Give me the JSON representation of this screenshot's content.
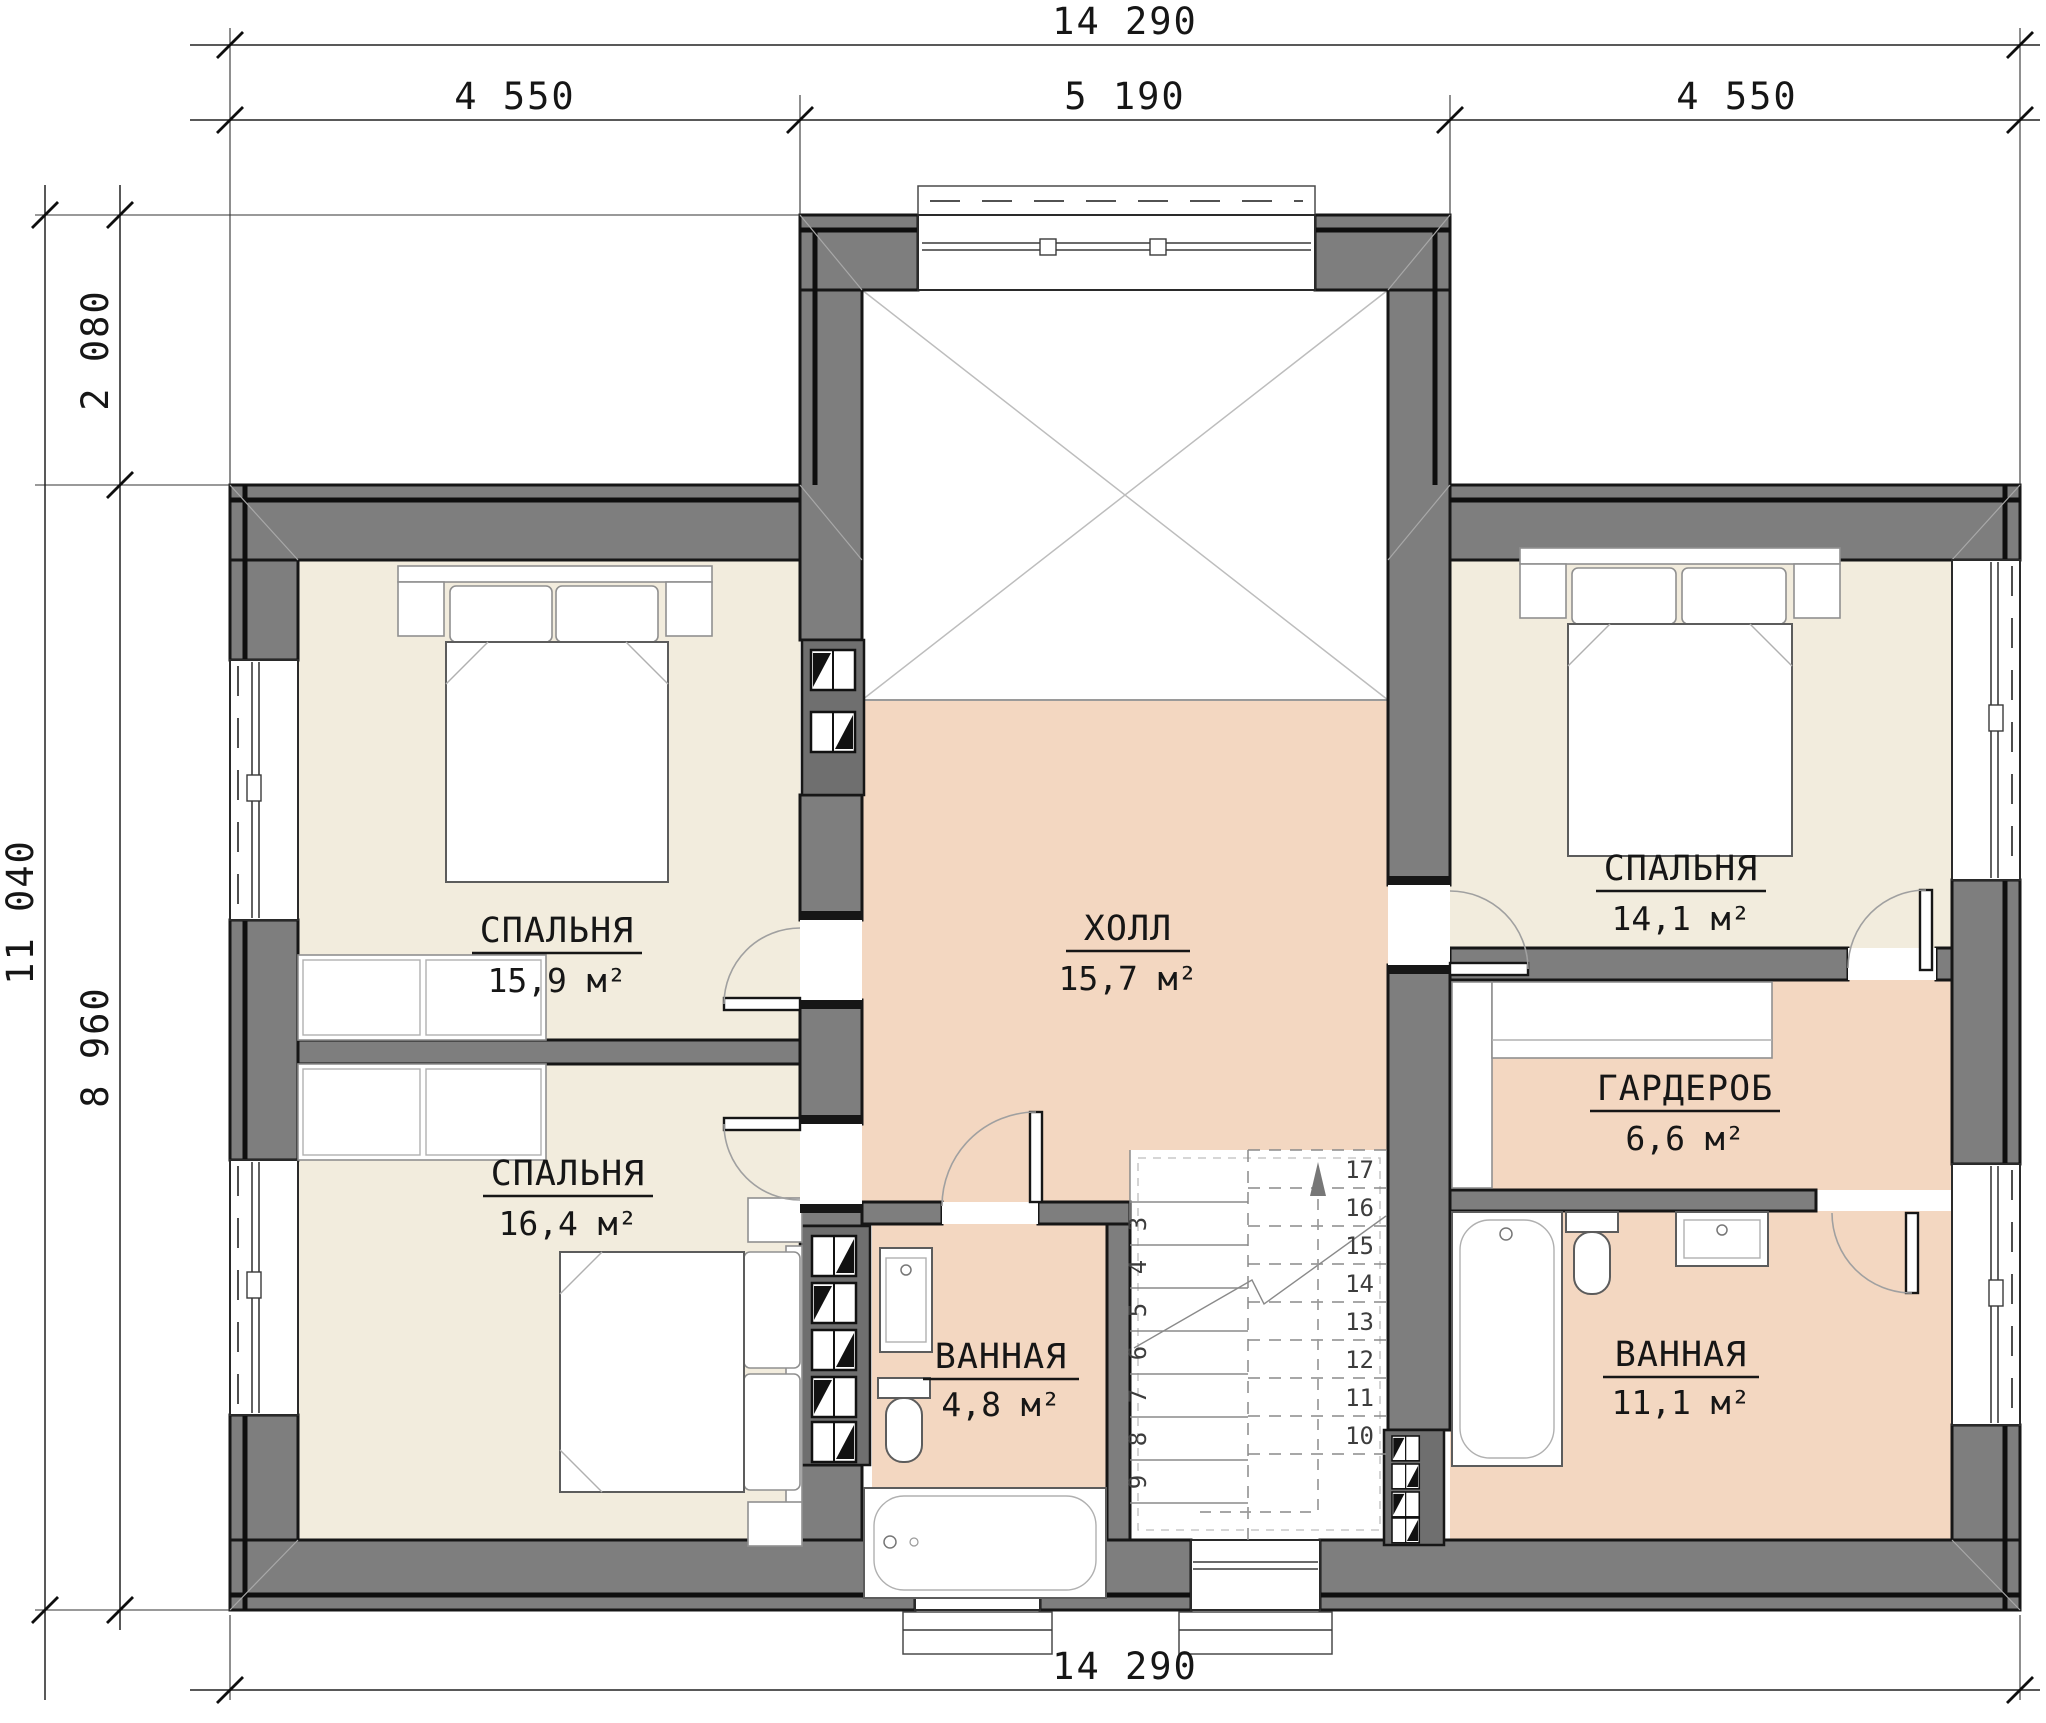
{
  "drawing": {
    "type": "architectural-floor-plan",
    "language": "ru"
  },
  "dimensions": {
    "top_total": "14 290",
    "top_segments": [
      "4 550",
      "5 190",
      "4 550"
    ],
    "left_total": "11 040",
    "left_segments": [
      "2 080",
      "8 960"
    ],
    "bottom_total": "14 290"
  },
  "rooms": {
    "bedroom_top_left": {
      "name": "СПАЛЬНЯ",
      "area": "15,9 м²"
    },
    "bedroom_bottom_left": {
      "name": "СПАЛЬНЯ",
      "area": "16,4 м²"
    },
    "hall": {
      "name": "ХОЛЛ",
      "area": "15,7 м²"
    },
    "bedroom_right": {
      "name": "СПАЛЬНЯ",
      "area": "14,1 м²"
    },
    "wardrobe": {
      "name": "ГАРДЕРОБ",
      "area": "6,6 м²"
    },
    "bathroom_small": {
      "name": "ВАННАЯ",
      "area": "4,8 м²"
    },
    "bathroom_large": {
      "name": "ВАННАЯ",
      "area": "11,1 м²"
    }
  },
  "stairs": {
    "lower": [
      "3",
      "4",
      "5",
      "6",
      "7",
      "8",
      "9"
    ],
    "upper": [
      "10",
      "11",
      "12",
      "13",
      "14",
      "15",
      "16",
      "17"
    ]
  },
  "colors": {
    "wall": "#7e7e7e",
    "bedroom_floor": "#f2ecdd",
    "wet_floor": "#f3d7c1",
    "line": "#161616"
  }
}
